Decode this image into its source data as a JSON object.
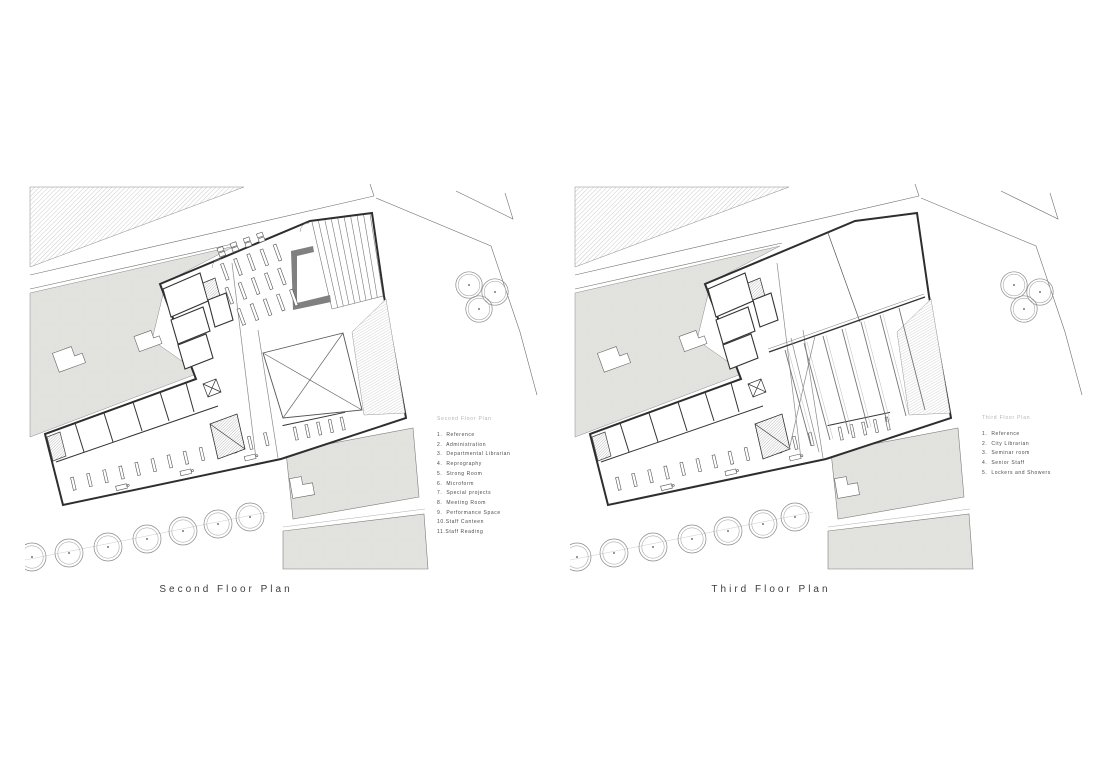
{
  "plans": [
    {
      "caption": "Second Floor Plan",
      "legend": {
        "title": "Second Floor Plan",
        "items": [
          "1.  Reference",
          "2.  Administration",
          "3.  Departmental Librarian",
          "4.  Reprography",
          "5.  Strong Room",
          "6.  Microform",
          "7.  Special projects",
          "8.  Meeting Room",
          "9.  Performance Space",
          "10.Staff Canteen",
          "11.Staff Reading"
        ]
      }
    },
    {
      "caption": "Third Floor Plan",
      "legend": {
        "title": "Third Floor Plan",
        "items": [
          "1.  Reference",
          "2.  City Librarian",
          "3.  Seminar room",
          "4.  Senior Staff",
          "5.  Lockers and Showers"
        ]
      }
    }
  ],
  "colors": {
    "wall_line": "#2e2e2e",
    "drawing_line": "#666666",
    "site_fill": "#e6e6e3",
    "legend_title_text": "#b3b3b3",
    "legend_item_text": "#4b4b4b",
    "caption_text": "#3d3d3d"
  }
}
